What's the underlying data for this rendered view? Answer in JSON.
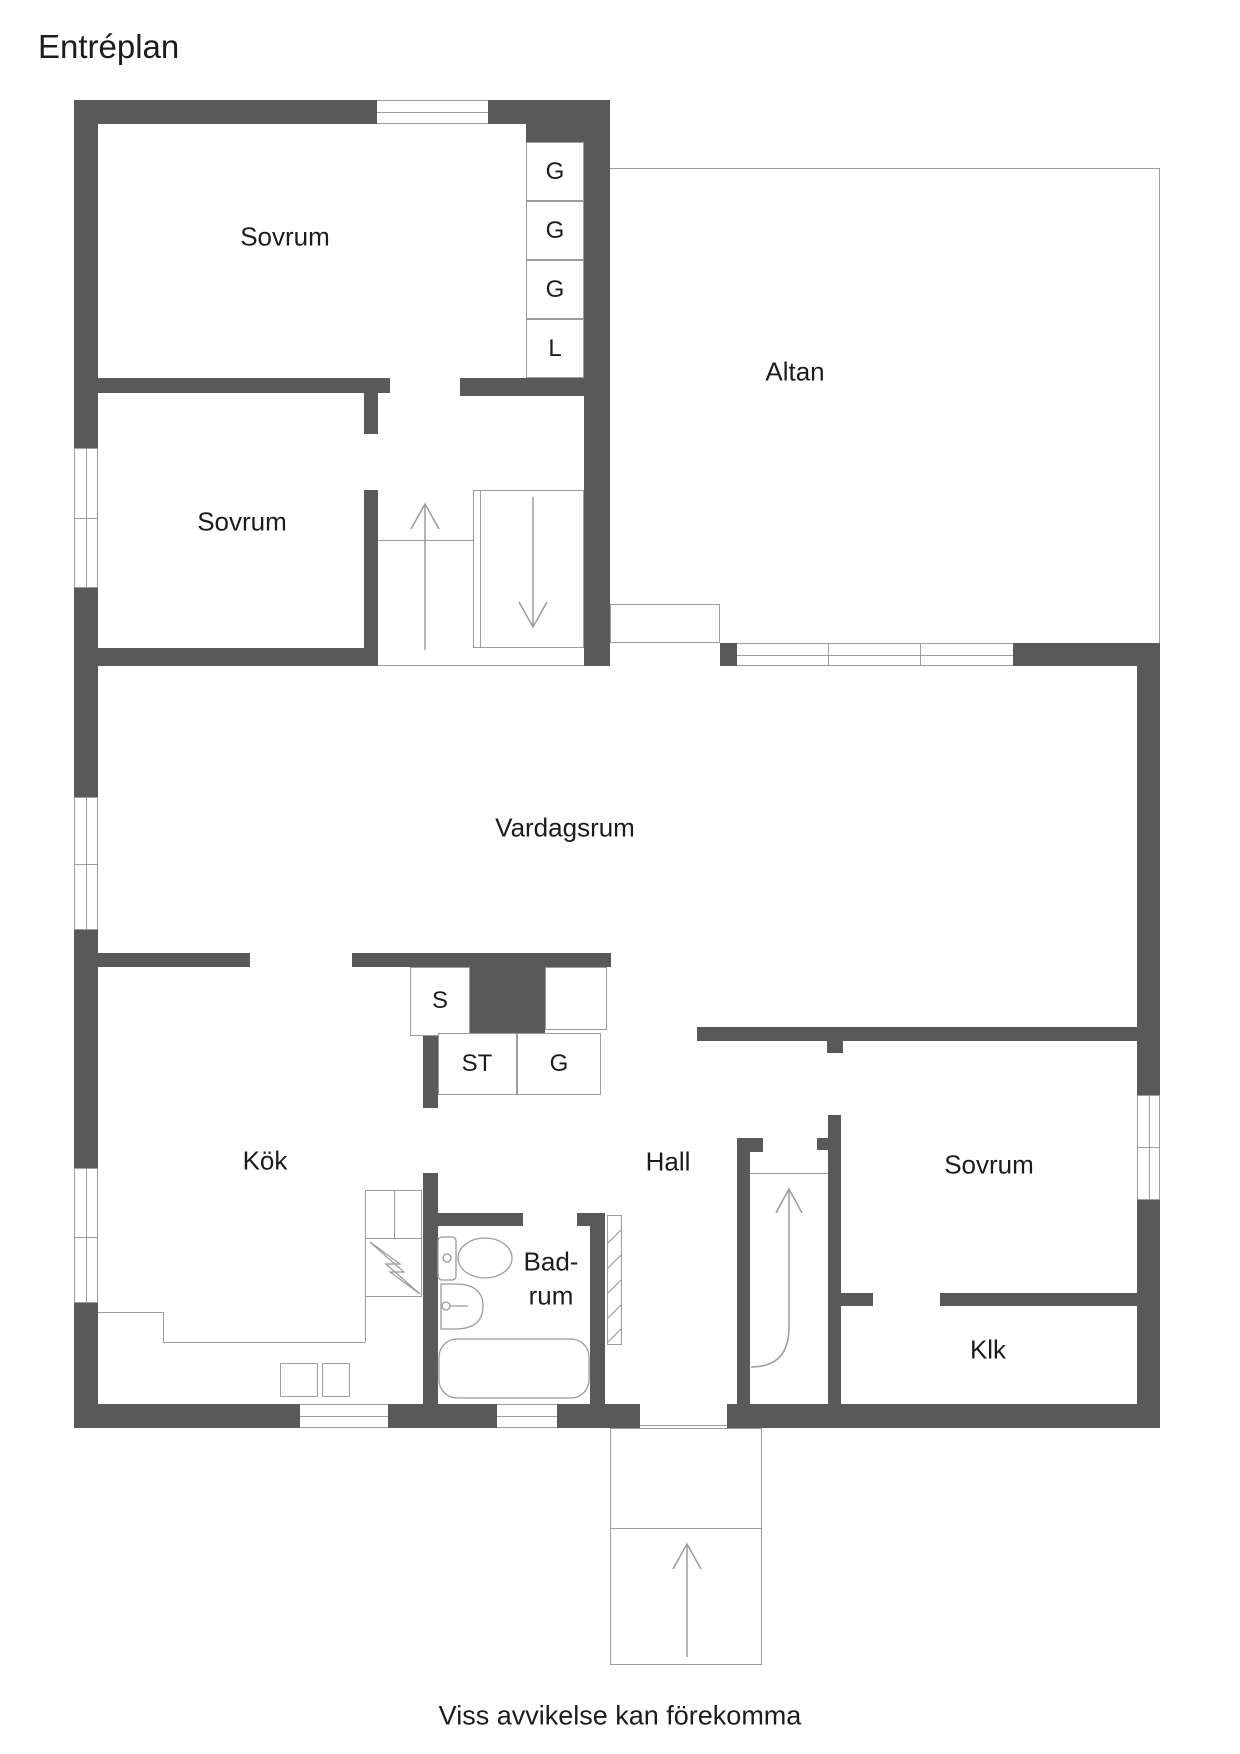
{
  "title": "Entréplan",
  "footer": "Viss avvikelse kan förekomma",
  "rooms": {
    "bedroom_nw": "Sovrum",
    "bedroom_w": "Sovrum",
    "bedroom_e": "Sovrum",
    "terrace": "Altan",
    "living_room": "Vardagsrum",
    "kitchen": "Kök",
    "hall": "Hall",
    "bathroom_line1": "Bad-",
    "bathroom_line2": "rum",
    "walkin_closet": "Klk"
  },
  "wardrobes": {
    "g1": "G",
    "g2": "G",
    "g3": "G",
    "linen": "L",
    "s": "S",
    "st": "ST",
    "g4": "G"
  },
  "colors": {
    "wall": "#595959",
    "thin_line": "#9b9b9b",
    "text": "#1c1c1c",
    "background": "#ffffff"
  }
}
